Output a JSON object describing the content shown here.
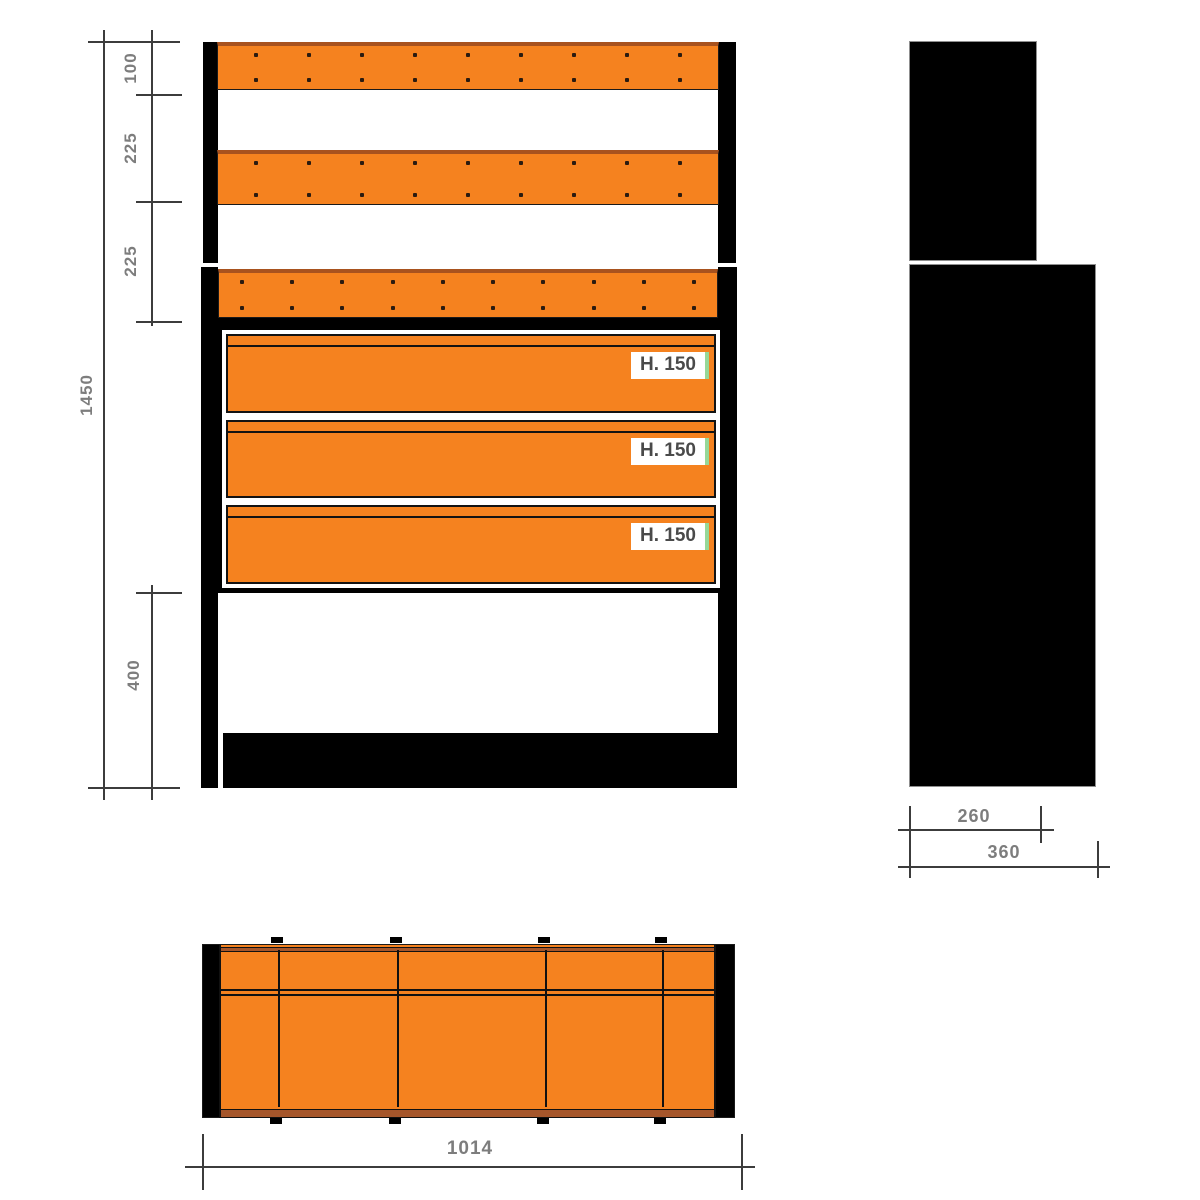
{
  "front_view": {
    "height_dims": [
      "100",
      "225",
      "225",
      "400"
    ],
    "overall_height_dim": "1450",
    "panels": [
      {
        "dots_per_row": 9,
        "dot_rows": 2
      },
      {
        "dots_per_row": 9,
        "dot_rows": 2
      },
      {
        "dots_per_row": 10,
        "dot_rows": 2
      }
    ],
    "drawers": [
      {
        "label": "H. 150"
      },
      {
        "label": "H. 150"
      },
      {
        "label": "H. 150"
      }
    ]
  },
  "side_view": {
    "depth_dim_upper": "260",
    "depth_dim_lower": "360"
  },
  "top_view": {
    "width_dim": "1014",
    "divider_x_px": [
      277,
      396,
      544,
      661
    ]
  },
  "colors": {
    "orange": "#F5821F",
    "frame_black": "#000000",
    "trim_brown": "#A5562B",
    "dim_text_gray": "#7d7d7d",
    "label_green_edge": "#97D897"
  }
}
